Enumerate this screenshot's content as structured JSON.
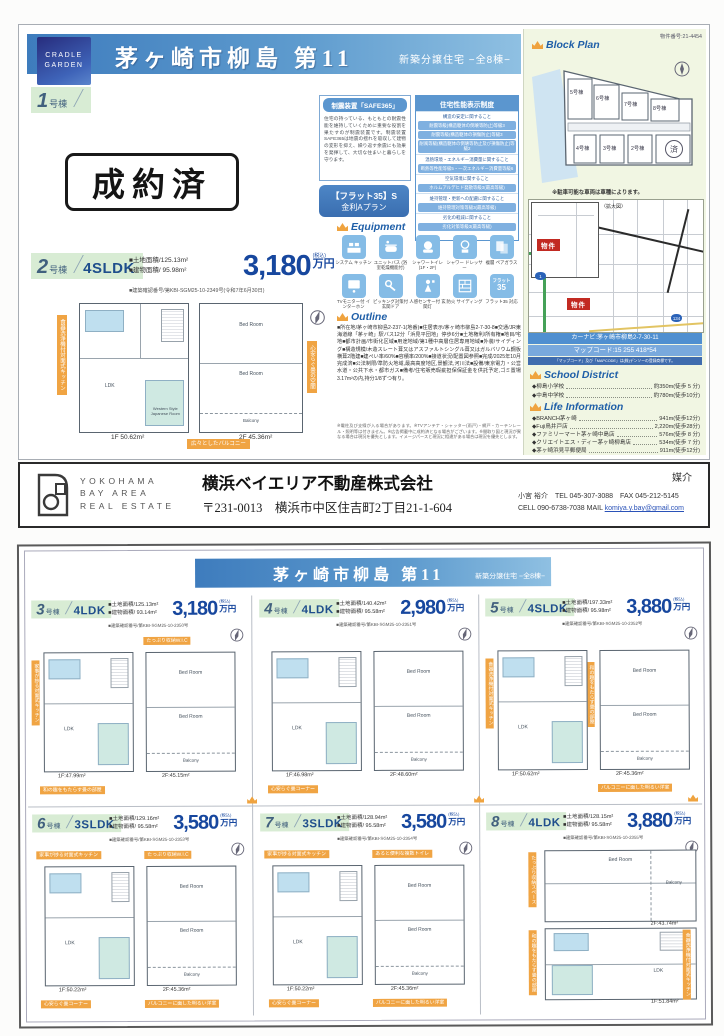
{
  "labels": {
    "unit_suffix": "号棟",
    "tax": "(税込)",
    "yen": "万円"
  },
  "rooms": {
    "ldk": "LDK",
    "bed": "Bed Room",
    "jp": "Western Style Japanese Room",
    "balcony": "Balcony"
  },
  "page1": {
    "brand": {
      "line1": "CRADLE",
      "line2": "GARDEN"
    },
    "title": "茅ヶ崎市柳島 第11",
    "subtitle": "新築分譲住宅 −全8棟−",
    "unit1": {
      "num": "1",
      "sold": "成約済"
    },
    "unit2": {
      "num": "2",
      "type": "4SLDK",
      "land": "■土地面積/125.13m²",
      "building": "■建物面積/ 95.98m²",
      "price": "3,180",
      "approval": "■建築確認番号/第KBI-SGM25-10-2349号(令和7年6月30日)",
      "f1": "1F 50.62m²",
      "f2": "2F 45.36m²",
      "tag_left": "食器洗浄機付対面式キッチン",
      "tag_mid": "心安らぐ畳の空間",
      "tag_bottom": "広々としたバルコニー"
    },
    "safe365": {
      "header": "制震装置「SAFE365」",
      "body": "住宅の持っている、もともとの耐震性能を維持していくために重要な役割を果たすのが制震装置です。制震装置SAFE365は地震の揺れを吸収して建物の変形を抑え、繰り返す余震にも効果を発揮して、大切な住まいと暮らしを守ります。"
    },
    "flat35": {
      "line1": "【フラット35】S",
      "line2": "金利Aプラン"
    },
    "performance": {
      "header": "住宅性能表示制度",
      "rows": [
        "構造の安定に関すること",
        "耐震等級(構造躯体の倒壊等防止)等級3",
        "耐震等級(構造躯体の損傷防止)等級3",
        "耐風等級(構造躯体の倒壊等防止及び損傷防止)等級2",
        "温熱環境・エネルギー消費量に関すること",
        "断熱等性能等級5・一次エネルギー消費量等級6",
        "空気環境に関すること",
        "ホルムアルデヒド発散等級3(最高等級)",
        "維持管理・更新への配慮に関すること",
        "維持管理対策等級3(最高等級)",
        "劣化の軽減に関すること",
        "劣化対策等級3(最高等級)"
      ]
    },
    "equipment": {
      "header": "Equipment",
      "items": [
        "システム キッチン",
        "ユニットバス (浴室乾燥機能付)",
        "シャワートイレ (1F・2F)",
        "シャワー ドレッサー",
        "複層 ペアガラス",
        "TVモニター付 インターホン",
        "ピッキング対策付 玄関ドア",
        "人感センサー付 玄関灯",
        "防火 サイディング",
        "フラット35 対応"
      ],
      "flat_icon_top": "フラット",
      "flat_icon_num": "35"
    },
    "outline": {
      "header": "Outline",
      "body": "■所在地/茅ヶ崎市柳島2-237-1(地番)■住居表示/茅ヶ崎市柳島2-7-30-8■交通/JR東海道線「茅ヶ崎」駅バス12分「浜見平団地」停歩6分■土地権利/所有権■地目/宅地■都市計画/市街化区域■用途地域/第1種中高層住居専用地域■外装/サイディング■構造規模/木造スレート葺又はアスファルトシングル葺又はガルバリウム鋼板横葺2階建■建ぺい率/60%■容積率/200%■接道状況/配置図参照■完成/2025年10月完成済■公法制限/準防火地域,最高高度地区,景観法,河川法■設備/東京電力・公営水道・公共下水・都市ガス■備考/住宅販売瑕疵担保保証金を供託予定,ゴミ置場3.17m²の内,持分1/8ずつ有り。",
      "note": "※電柱及び支線が入る場合があります。※TVアンテナ・シャッター(雨戸)・網戸・カーテンレール・照明等は付きません。※広告掲載中に成約済となる場合がございます。※間取り図と現況が異なる場合は現況を優先とします。イメージパースと現況に相違がある場合は現況を優先とします。"
    },
    "blockplan": {
      "header": "Block Plan",
      "property_no": "物件番号:21-4454",
      "note": "※駐車可能な車両は車種によります。",
      "lots": [
        "5号棟",
        "6号棟",
        "7号棟",
        "8号棟",
        "4号棟",
        "3号棟",
        "2号棟"
      ],
      "sold_mark": "済"
    },
    "map": {
      "inset_label": "〈拡大図〉",
      "marker": "物件",
      "route1": "1",
      "route134": "134",
      "navi": "カーナビ:茅ヶ崎市柳島2-7-30-11",
      "mapcode": "マップコード:15 255 418*54",
      "mapnote": "「マップコード」及び「MAPCODE」は(株)デンソーの登録商標です。"
    },
    "school": {
      "header": "School District",
      "items": [
        {
          "name": "◆柳島小学校",
          "dist": "約350m(徒歩 5 分)"
        },
        {
          "name": "◆中島中学校",
          "dist": "約780m(徒歩10分)"
        }
      ]
    },
    "life": {
      "header": "Life Information",
      "items": [
        {
          "name": "◆BRANCH茅ヶ崎",
          "dist": "941m(徒歩12分)"
        },
        {
          "name": "◆Fuji鳥井戸店",
          "dist": "2,220m(徒歩28分)"
        },
        {
          "name": "◆ファミリーマート茅ヶ崎中島店",
          "dist": "576m(徒歩 8 分)"
        },
        {
          "name": "◆クリエイトエス・ディー茅ヶ崎柳島店",
          "dist": "534m(徒歩 7 分)"
        },
        {
          "name": "◆茅ヶ崎浜見平郵便局",
          "dist": "911m(徒歩12分)"
        }
      ]
    }
  },
  "footer": {
    "logo_line1": "YOKOHAMA",
    "logo_line2": "BAY AREA",
    "logo_line3": "REAL ESTATE",
    "company": "横浜ベイエリア不動産株式会社",
    "address": "〒231-0013　横浜市中区住吉町2丁目21-1-604",
    "mediation": "媒介",
    "agent": "小宮 裕介　TEL 045-307-3088　FAX 045-212-5145",
    "contact_cell": "CELL 090‐6738‐7038 MAIL ",
    "contact_mail": "komiya.y.bay@gmail.com"
  },
  "page2": {
    "title": "茅ヶ崎市柳島 第11",
    "subtitle": "新築分譲住宅 −全8棟−",
    "units": [
      {
        "num": "3",
        "type": "4LDK",
        "land": "■土地面積/125.13m²",
        "building": "■建物面積/ 93.14m²",
        "price": "3,180",
        "approval": "■建築確認番号/第KBI-SGM25-10-2350号",
        "f1": "1F:47.99m²",
        "f2": "2F:45.15m²",
        "tagB": "たっぷり収納W.I.C",
        "tagL": "家事が捗る対面式キッチン",
        "tagC": "和の趣をもたらす畳の部屋"
      },
      {
        "num": "4",
        "type": "4LDK",
        "land": "■土地面積/140.42m²",
        "building": "■建物面積/ 95.58m²",
        "price": "2,980",
        "approval": "■建築確認番号/第KBI-SGM25-10-2351号",
        "f1": "1F:46.98m²",
        "f2": "2F:48.60m²",
        "tagC": "心安らぐ畳コーナー"
      },
      {
        "num": "5",
        "type": "4SLDK",
        "land": "■土地面積/197.33m²",
        "building": "■建物面積/ 95.98m²",
        "price": "3,880",
        "approval": "■建築確認番号/第KBI-SGM25-10-2352号",
        "f1": "1F:50.62m²",
        "f2": "2F:45.36m²",
        "tagL": "食器洗浄機付対面式キッチン",
        "tagM": "和の趣をもたらす畳の部屋",
        "tagD": "バルコニーに面した明るい洋室"
      },
      {
        "num": "6",
        "type": "3SLDK",
        "land": "■土地面積/129.16m²",
        "building": "■建物面積/ 95.58m²",
        "price": "3,580",
        "approval": "■建築確認番号/第KBI-SGM25-10-2353号",
        "f1": "1F:50.22m²",
        "f2": "2F:45.36m²",
        "tagA": "家事が捗る対面式キッチン",
        "tagB": "たっぷり収納W.I.C",
        "tagC": "心安らぐ畳コーナー",
        "tagD": "バルコニーに面した明るい洋室"
      },
      {
        "num": "7",
        "type": "3SLDK",
        "land": "■土地面積/128.94m²",
        "building": "■建物面積/ 95.58m²",
        "price": "3,580",
        "approval": "■建築確認番号/第KBI-SGM25-10-2354号",
        "f1": "1F:50.22m²",
        "f2": "2F:45.36m²",
        "tagA": "家事が捗る対面式キッチン",
        "tagB": "あると便利な複数トイレ",
        "tagC": "心安らぐ畳コーナー",
        "tagD": "バルコニーに面した明るい洋室"
      },
      {
        "num": "8",
        "type": "4LDK",
        "land": "■土地面積/128.15m²",
        "building": "■建物面積/ 95.58m²",
        "price": "3,880",
        "approval": "■建築確認番号/第KBI-SGM25-10-2355号",
        "f1": "1F:51.84m²",
        "f2": "2F:43.74m²",
        "tagA": "たっぷり収納スペース",
        "tagB": "広々としたバルコニー",
        "tagC": "和の趣をもたらす畳の部屋",
        "tagD": "食器洗浄機付対面式キッチン"
      }
    ]
  }
}
